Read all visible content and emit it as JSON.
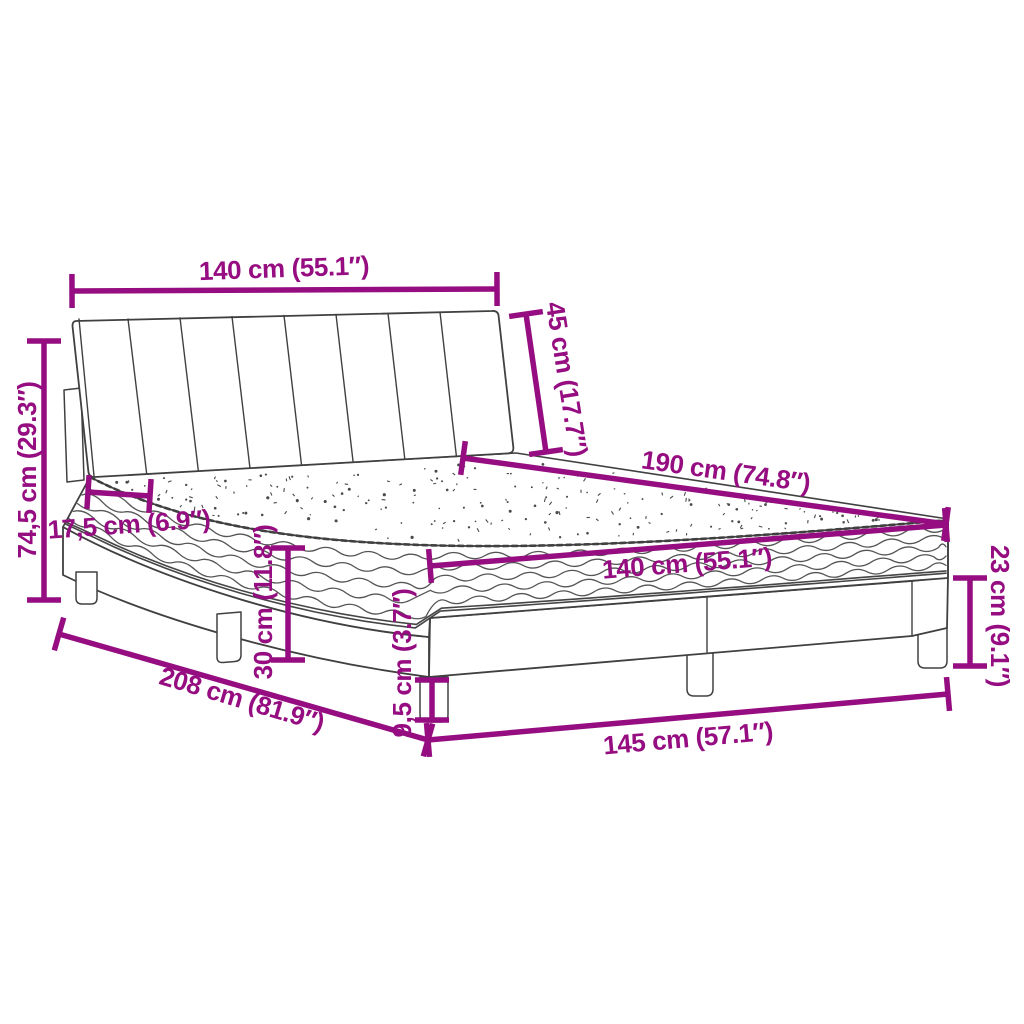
{
  "diagram": {
    "subject": "bed-with-mattress-dimension-diagram"
  },
  "colors": {
    "dimension": "#950D80",
    "drawing": "#404040",
    "background": "#FFFFFF"
  },
  "dimensions": {
    "headboard_width": {
      "text": "140 cm (55.1″)",
      "value_cm": "140",
      "value_in": "55.1"
    },
    "headboard_height": {
      "text": "45 cm (17.7″)",
      "value_cm": "45",
      "value_in": "17.7"
    },
    "total_height": {
      "text": "74,5 cm (29.3″)",
      "value_cm": "74,5",
      "value_in": "29.3"
    },
    "mattress_length": {
      "text": "190 cm (74.8″)",
      "value_cm": "190",
      "value_in": "74.8"
    },
    "mattress_width": {
      "text": "140 cm (55.1″)",
      "value_cm": "140",
      "value_in": "55.1"
    },
    "mattress_thickness": {
      "text": "17,5 cm (6.9″)",
      "value_cm": "17,5",
      "value_in": "6.9"
    },
    "base_height": {
      "text": "30 cm (11.8″)",
      "value_cm": "30",
      "value_in": "11.8"
    },
    "total_length": {
      "text": "208 cm (81.9″)",
      "value_cm": "208",
      "value_in": "81.9"
    },
    "base_length": {
      "text": "145 cm (57.1″)",
      "value_cm": "145",
      "value_in": "57.1"
    },
    "leg_height": {
      "text": "9,5 cm (3.7″)",
      "value_cm": "9,5",
      "value_in": "3.7"
    },
    "foot_end_height": {
      "text": "23 cm (9.1″)",
      "value_cm": "23",
      "value_in": "9.1"
    }
  }
}
